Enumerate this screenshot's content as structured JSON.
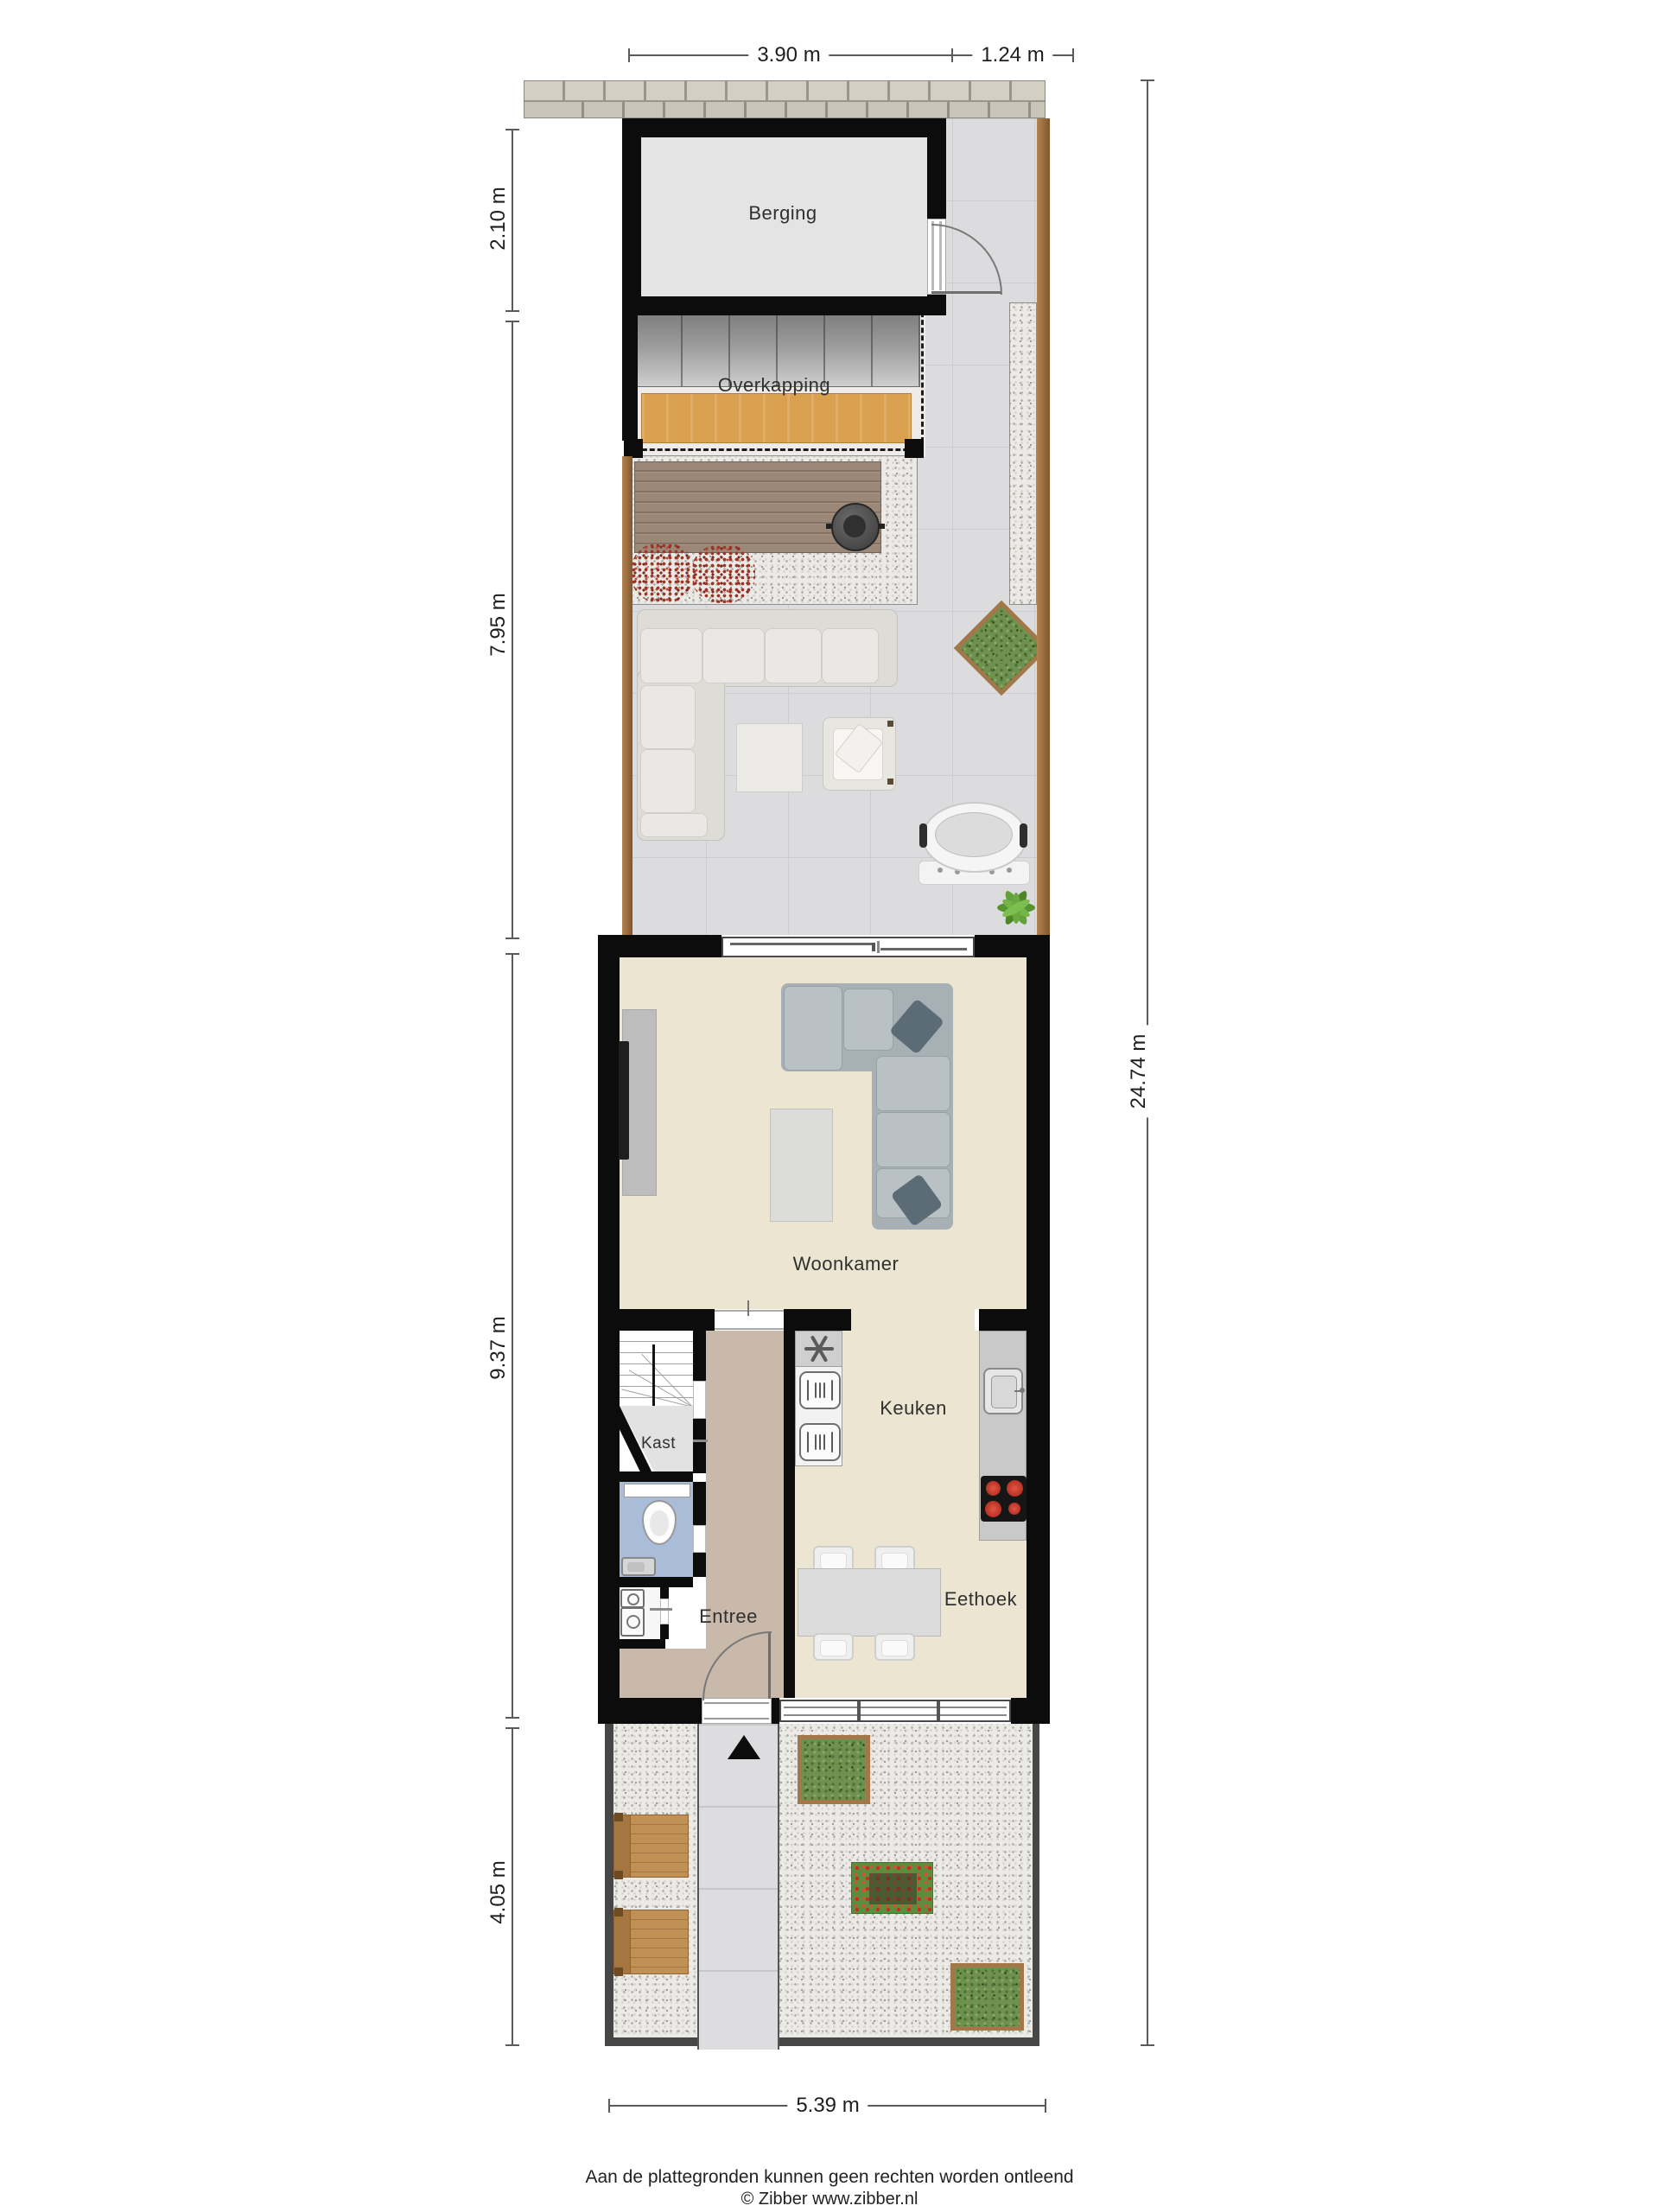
{
  "dimensions": {
    "top_main": "3.90 m",
    "top_side": "1.24 m",
    "left_berging": "2.10 m",
    "left_garden": "7.95 m",
    "left_house": "9.37 m",
    "left_front": "4.05 m",
    "right_total": "24.74 m",
    "bottom_width": "5.39 m"
  },
  "rooms": {
    "berging": "Berging",
    "overkapping": "Overkapping",
    "woonkamer": "Woonkamer",
    "kast": "Kast",
    "keuken": "Keuken",
    "entree": "Entree",
    "eethoek": "Eethoek"
  },
  "footer": {
    "disclaimer": "Aan de plattegronden kunnen geen rechten worden ontleend",
    "copyright": "© Zibber www.zibber.nl"
  },
  "colors": {
    "wall": "#0c0c0c",
    "house_floor": "#ebe5d1",
    "entree_floor": "#c8b9ab",
    "toilet_floor": "#aabdd8",
    "berging_floor": "#e4e4e4",
    "tile": "#dcdcde",
    "wood_fence": "#a2774a",
    "wood_table": "#d9a050",
    "burner_red": "#c0392b",
    "sofa_gray": "#aab3b8"
  }
}
